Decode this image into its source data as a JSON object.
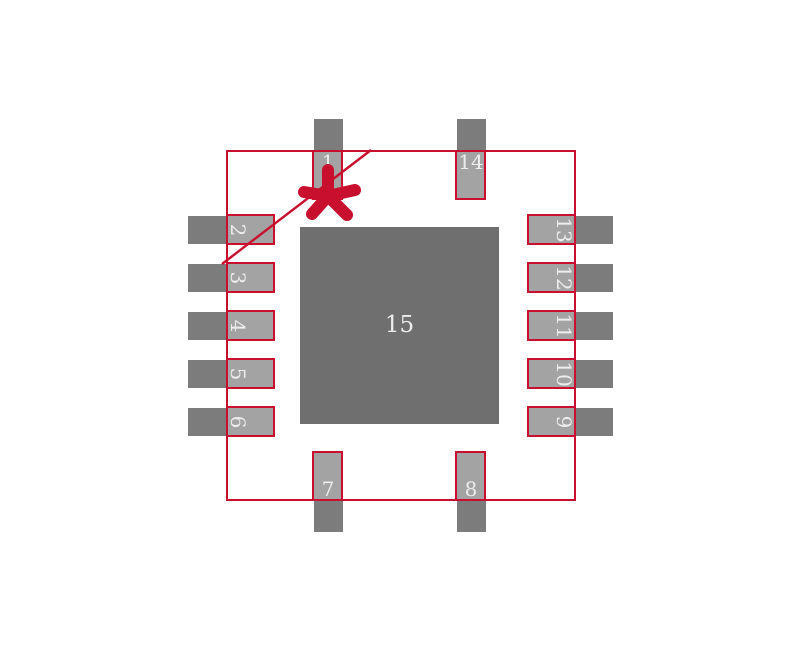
{
  "footprint": {
    "center_pad": {
      "label": "15"
    },
    "pins": [
      {
        "label": "1",
        "side": "top",
        "slot": 0
      },
      {
        "label": "2",
        "side": "left",
        "slot": 0
      },
      {
        "label": "3",
        "side": "left",
        "slot": 1
      },
      {
        "label": "4",
        "side": "left",
        "slot": 2
      },
      {
        "label": "5",
        "side": "left",
        "slot": 3
      },
      {
        "label": "6",
        "side": "left",
        "slot": 4
      },
      {
        "label": "7",
        "side": "bottom",
        "slot": 0
      },
      {
        "label": "8",
        "side": "bottom",
        "slot": 1
      },
      {
        "label": "9",
        "side": "right",
        "slot": 4
      },
      {
        "label": "10",
        "side": "right",
        "slot": 3
      },
      {
        "label": "11",
        "side": "right",
        "slot": 2
      },
      {
        "label": "12",
        "side": "right",
        "slot": 1
      },
      {
        "label": "13",
        "side": "right",
        "slot": 0
      },
      {
        "label": "14",
        "side": "top",
        "slot": 1
      }
    ],
    "markers": {
      "pin1_indicator": "asterisk-star",
      "pin1_reference": "diagonal-line"
    },
    "colors": {
      "outline_red": "#c8102e",
      "pad_copper_gray": "#7c7c7c",
      "pad_paste_gray": "#a3a3a3",
      "thermal_pad_gray": "#6f6f6f",
      "pad_number_text": "#ededed",
      "background": "#ffffff"
    }
  }
}
